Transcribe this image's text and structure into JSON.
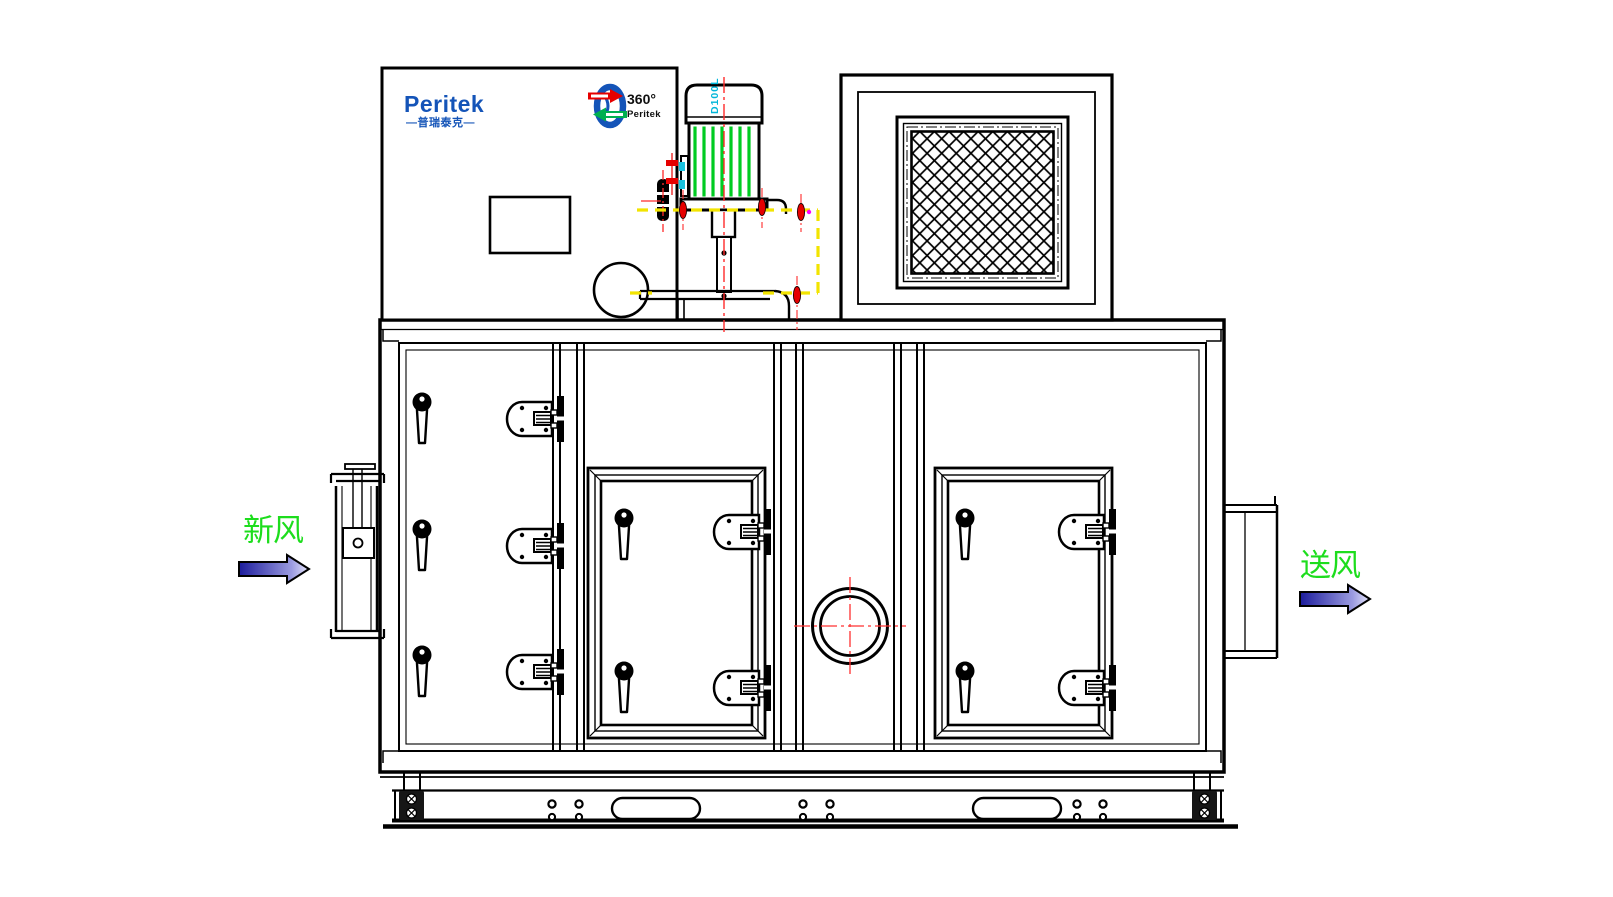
{
  "title_block": {
    "brand": "Peritek",
    "brand_cn": "—普瑞泰克—"
  },
  "rotor_logo": {
    "degrees": "360°",
    "brand": "Peritek"
  },
  "motor": {
    "model": "D100L"
  },
  "flow_labels": {
    "inlet": "新风",
    "outlet": "送风"
  },
  "colors": {
    "brand_blue": "#1454b8",
    "motor_fin_green": "#00cc22",
    "label_green": "#1ddd1d",
    "centerline_red": "#ff2a2a",
    "bolt_red": "#e60000",
    "guard_yellow": "#f2e400",
    "model_cyan": "#00b6d9",
    "logo_arrow_red": "#e60000",
    "logo_arrow_green": "#00b050",
    "flow_arrow_gradient_start": "#1c1c9c",
    "flow_arrow_gradient_end": "#e6e6fb",
    "line_black": "#000000"
  }
}
